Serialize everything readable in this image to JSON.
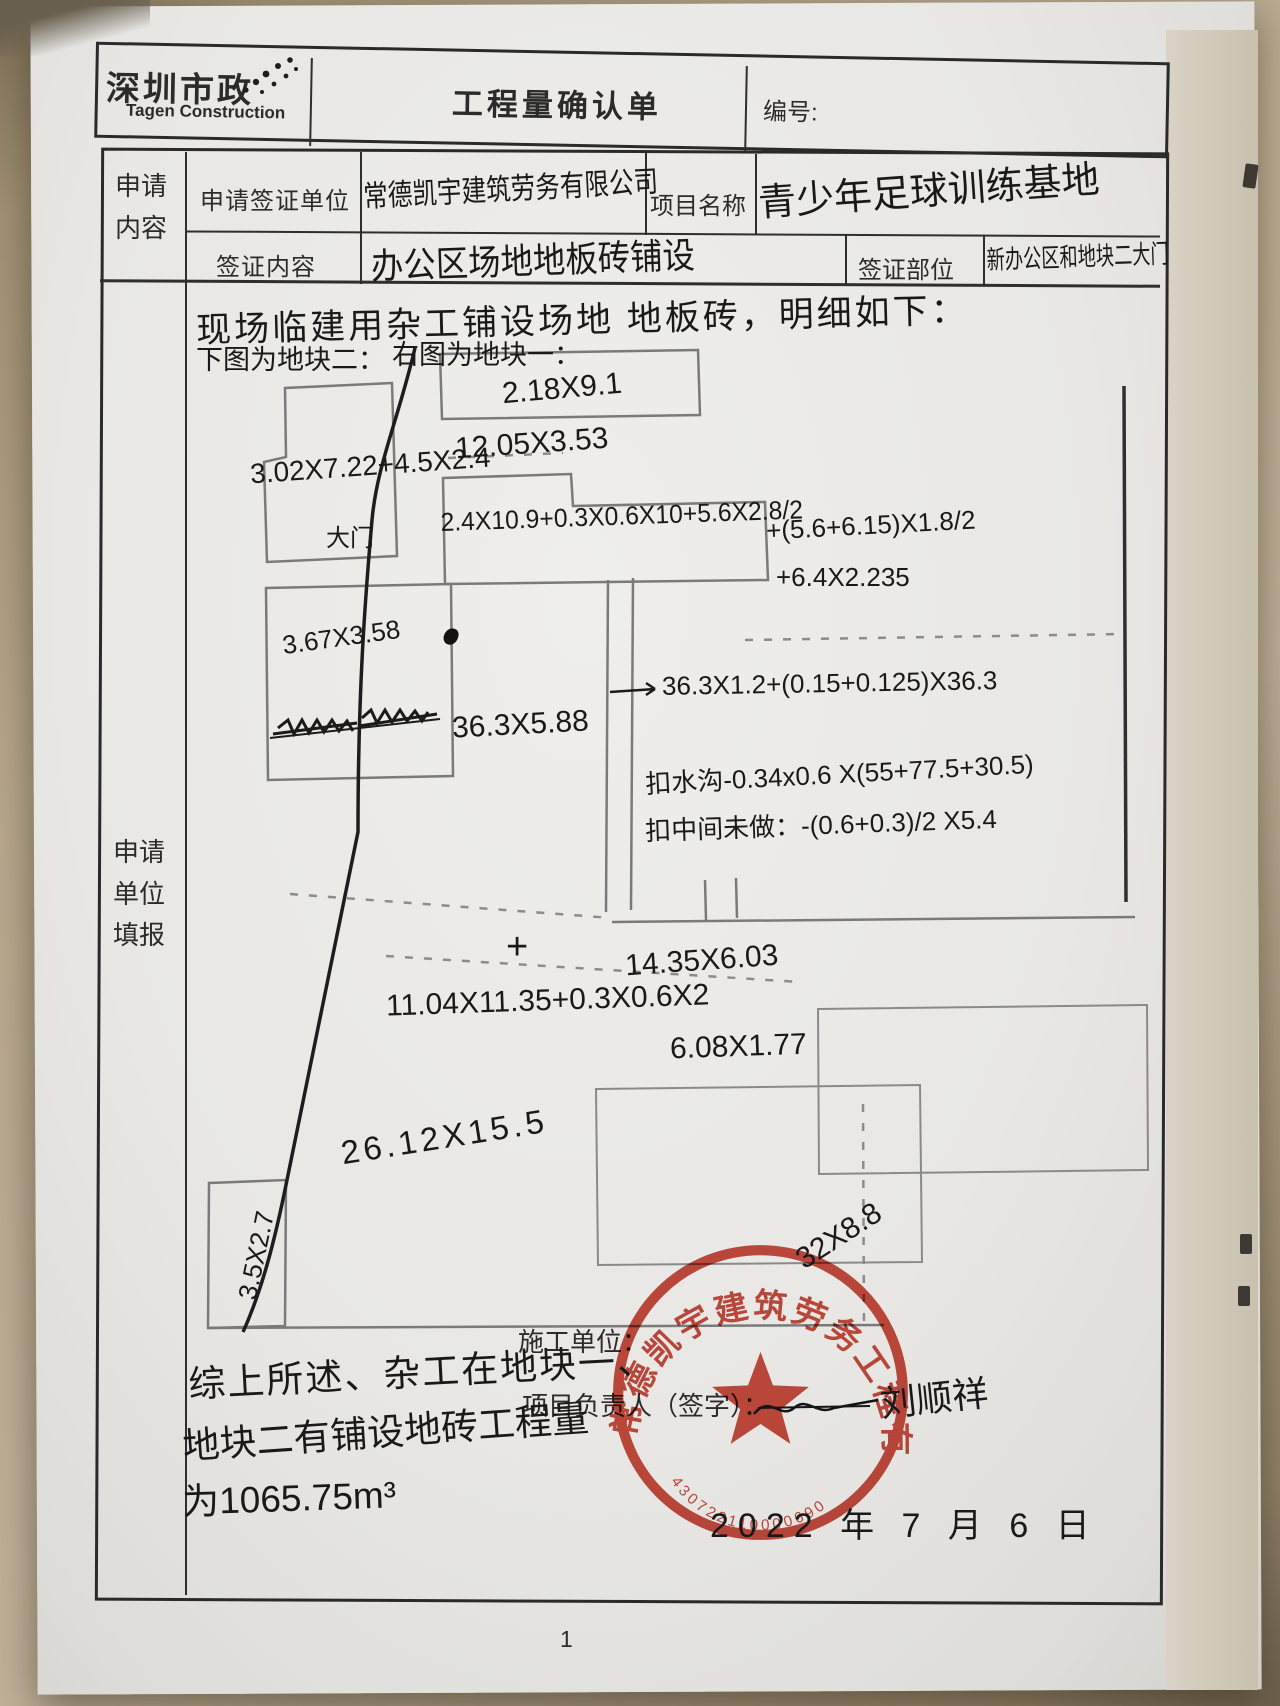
{
  "header": {
    "logo_cn": "深圳市政",
    "logo_en": "Tagen Construction",
    "title": "工程量确认单",
    "number_label": "编号:"
  },
  "form": {
    "left_label_top": "申请内容",
    "left_label_main": "申请单位填报",
    "row1": {
      "label1": "申请签证单位",
      "value1": "常德凯宇建筑劳务有限公司",
      "label2": "项目名称",
      "value2": "青少年足球训练基地"
    },
    "row2": {
      "label1": "签证内容",
      "value1": "办公区场地地板砖铺设",
      "label2": "签证部位",
      "value2": "新办公区和地块二大门"
    }
  },
  "notes": {
    "line1": "现场临建用杂工铺设场地 地板砖，明细如下：",
    "caption_left": "下图为地块二：",
    "caption_right": "右图为地块一："
  },
  "diagram": {
    "top_rect": "2.18X9.1",
    "rect_1205": "12.05X3.53",
    "lshape": "3.02X7.22+4.5X2.4",
    "gate": "大门",
    "formula_row": "2.4X10.9+0.3X0.6X10+5.6X2.8/2",
    "formula_right1": "+(5.6+6.15)X1.8/2",
    "formula_right2": "+6.4X2.235",
    "rect_367": "3.67X3.58",
    "arrow_formula": "36.3X1.2+(0.15+0.125)X36.3",
    "m_363": "36.3X5.88",
    "deduct_ditch": "扣水沟-0.34x0.6 X(55+77.5+30.5)",
    "deduct_mid": "扣中间未做：-(0.6+0.3)/2 X5.4",
    "m_1435": "14.35X6.03",
    "m_1104": "11.04X11.35+0.3X0.6X2",
    "plus_mark": "+",
    "m_608": "6.08X1.77",
    "m_2612": "26.12X15.5",
    "m_35": "3.5X2.7",
    "m_32": "32X8.8"
  },
  "footer": {
    "summary1": "综上所述、杂工在地块一、",
    "summary2": "地块二有铺设地砖工程量",
    "summary3": "为1065.75m³",
    "constructor_label": "施工单位：",
    "manager_label": "项目负责人（签字）：",
    "signature": "刘顺祥",
    "date": "2022 年 7 月 6 日",
    "page": "1"
  },
  "stamp": {
    "company": "常德凯宇建筑劳务工程有限公司",
    "number": "430722110000690"
  },
  "colors": {
    "stamp_red": "#c5392b",
    "ink": "#1b1b1b",
    "pencil": "#7a7a7a"
  }
}
